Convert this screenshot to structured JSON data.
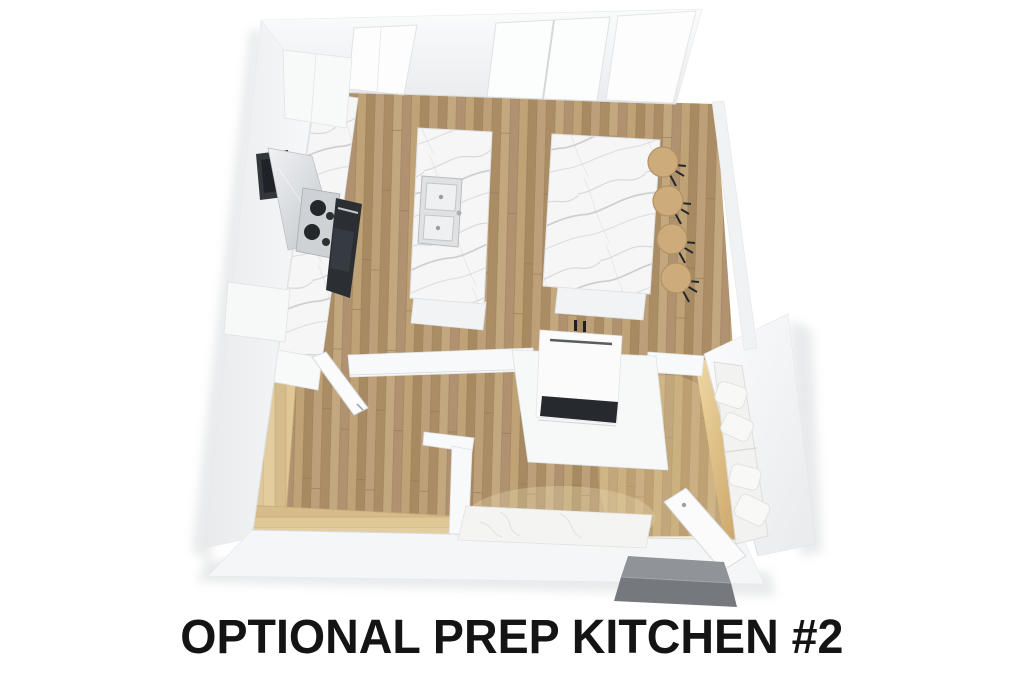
{
  "caption": {
    "text": "OPTIONAL PREP KITCHEN #2",
    "color": "#141414"
  },
  "colors": {
    "background": "#ffffff",
    "floor_wood": "#b3946c",
    "banquette_wood": "#dcc394",
    "platform_glow_wood": "#d9b87f",
    "marble": "#f5f5f6",
    "wall_white": "#f4f5f6",
    "appliance_dark": "#31353a",
    "stool_wood": "#cdab7b",
    "concrete_step": "#7e8185"
  },
  "scene": {
    "view": "top-down 3D rendered floor plan",
    "objects": [
      "kitchen counter with range, hood and oven",
      "prep island with double sink",
      "dining island with four bar stools",
      "two-sided fireplace in partition wall",
      "sofa with pillows on wood platform",
      "upholstered daybed bench",
      "L-shaped wood banquette",
      "open interior door",
      "open entry door",
      "concrete entry step",
      "top wall windows"
    ]
  }
}
